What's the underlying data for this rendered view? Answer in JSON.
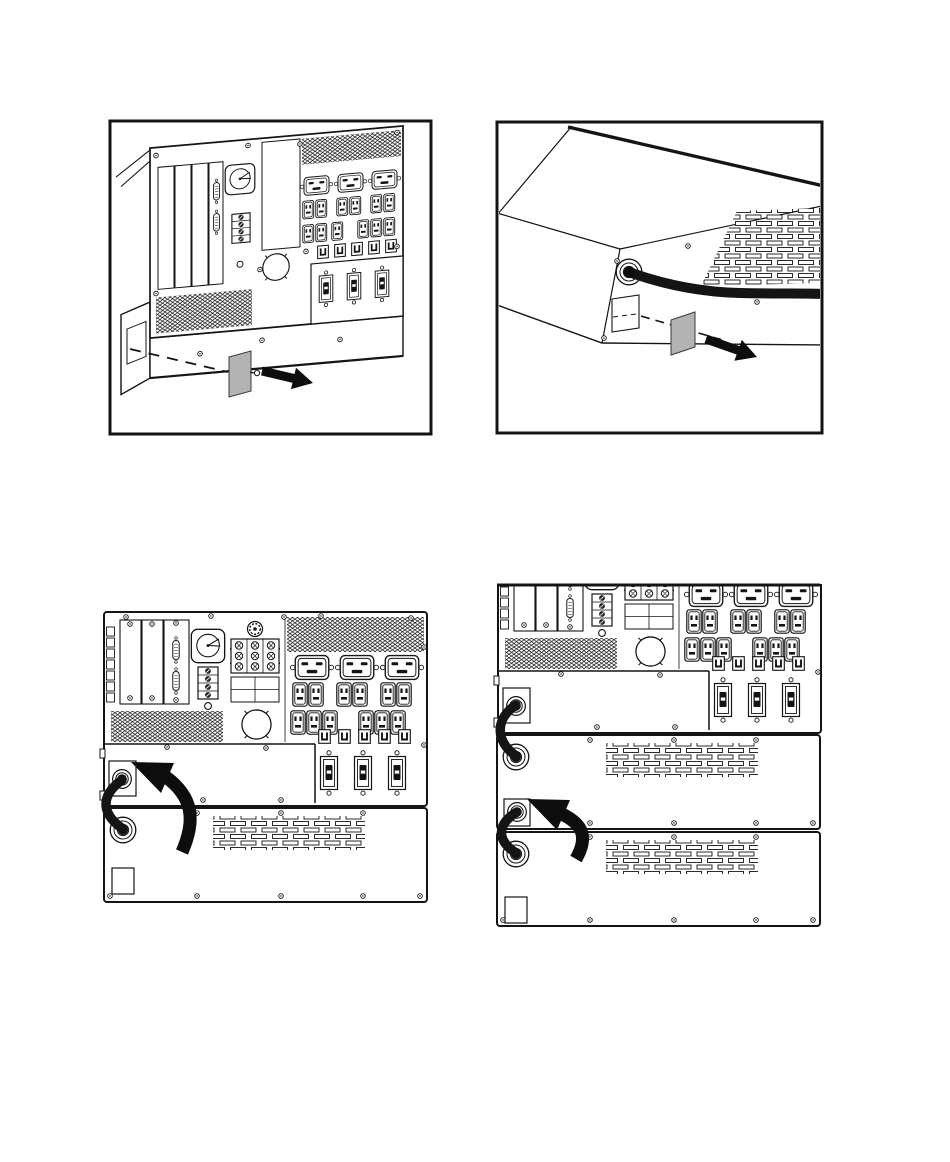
{
  "page": {
    "background": "#ffffff",
    "description": "Technical manual page with four line-art illustrations of UPS rear panels and external battery packs"
  },
  "colors": {
    "line": "#141414",
    "fill": "#ffffff",
    "knockout_tab_gray": "#b3b3b3",
    "arrow_black": "#0d0d0d"
  },
  "figures": [
    {
      "name": "ups-rear-knockout-removal",
      "description": "Perspective view of UPS rear panel: expansion slots, serial ports, rotary switch, terminal block, outlet groups and circuit breakers; dashed guide line to a removable gray knockout cover plate with screw and a black arrow pointing right",
      "framed": true,
      "components": [
        "frame",
        "rear-panel",
        "expansion-slots",
        "db9-ports",
        "rotary-switch",
        "terminal-block",
        "vent-grille",
        "c19-outlets",
        "c13-outlets",
        "small-breakers",
        "large-breakers",
        "fan-knockout",
        "side-knockout",
        "dashed-guide",
        "knockout-cover-plate",
        "screw",
        "removal-arrow"
      ]
    },
    {
      "name": "battery-pack-corner-knockout-removal",
      "description": "Corner perspective view of an external battery pack: cable gland with thick battery cable, louvered vent, square knockout opening, gray knockout cover plate with screw and a black arrow pointing right",
      "framed": true,
      "components": [
        "frame",
        "chassis-corner",
        "cable-gland",
        "battery-cable",
        "louver-vent",
        "square-knockout",
        "dashed-guide",
        "knockout-cover-plate",
        "screw",
        "removal-arrow"
      ]
    },
    {
      "name": "ups-with-one-battery-pack",
      "description": "Straight-on rear view of UPS stacked on one external battery pack; battery cable routed from UPS gland to battery pack gland with a curved black arrow showing the connection",
      "framed": false,
      "components": [
        "rear-panel",
        "battery-pack",
        "cable-gland",
        "battery-cable",
        "curved-arrow",
        "louver-vent",
        "square-knockout"
      ]
    },
    {
      "name": "ups-with-two-battery-packs",
      "description": "Straight-on rear view of UPS stacked on two external battery packs; battery cables daisy-chained between glands with a curved black arrow showing the second connection",
      "framed": false,
      "components": [
        "rear-panel",
        "battery-pack-1",
        "battery-pack-2",
        "cable-glands",
        "battery-cables",
        "curved-arrow",
        "louver-vents",
        "square-knockout"
      ]
    }
  ]
}
